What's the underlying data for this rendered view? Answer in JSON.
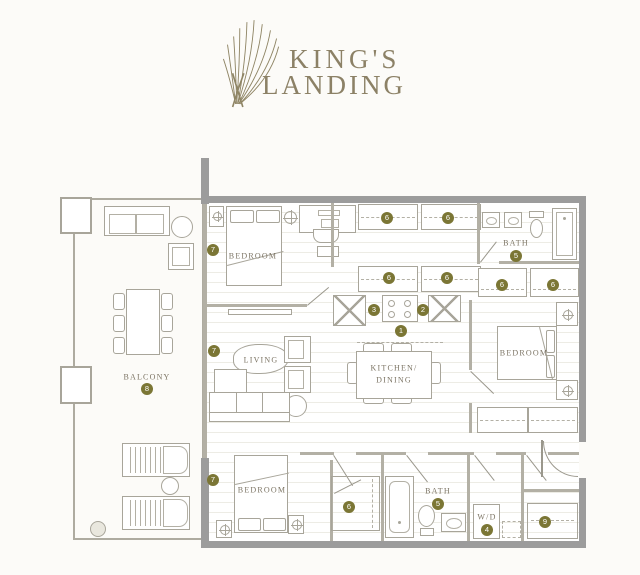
{
  "logo": {
    "line1": "KING'S",
    "line2": "LANDING",
    "icon": "leaf-fan-icon"
  },
  "colors": {
    "brand_gold": "#8c8166",
    "marker_olive": "#7b7635",
    "marker_text": "#ffffff",
    "wall_gray": "#9c9c9c",
    "label_brown": "#7c7464",
    "background": "#fcfbf8"
  },
  "plan": {
    "room_labels": [
      {
        "text": "BEDROOM",
        "x": 253,
        "y": 256
      },
      {
        "text": "BATH",
        "x": 516,
        "y": 243
      },
      {
        "text": "BEDROOM",
        "x": 524,
        "y": 353
      },
      {
        "text": "LIVING",
        "x": 261,
        "y": 360
      },
      {
        "text": "KITCHEN/",
        "x": 394,
        "y": 368
      },
      {
        "text": "DINING",
        "x": 394,
        "y": 380
      },
      {
        "text": "BALCONY",
        "x": 147,
        "y": 377
      },
      {
        "text": "BEDROOM",
        "x": 262,
        "y": 490
      },
      {
        "text": "BATH",
        "x": 438,
        "y": 491
      },
      {
        "text": "W/D",
        "x": 487,
        "y": 517
      }
    ],
    "markers": [
      {
        "n": "1",
        "x": 401,
        "y": 331
      },
      {
        "n": "2",
        "x": 423,
        "y": 310
      },
      {
        "n": "3",
        "x": 374,
        "y": 310
      },
      {
        "n": "4",
        "x": 487,
        "y": 530
      },
      {
        "n": "5",
        "x": 516,
        "y": 256
      },
      {
        "n": "5",
        "x": 438,
        "y": 504
      },
      {
        "n": "6",
        "x": 387,
        "y": 218
      },
      {
        "n": "6",
        "x": 448,
        "y": 218
      },
      {
        "n": "6",
        "x": 389,
        "y": 278
      },
      {
        "n": "6",
        "x": 447,
        "y": 278
      },
      {
        "n": "6",
        "x": 502,
        "y": 285
      },
      {
        "n": "6",
        "x": 553,
        "y": 285
      },
      {
        "n": "6",
        "x": 349,
        "y": 507
      },
      {
        "n": "7",
        "x": 213,
        "y": 250
      },
      {
        "n": "7",
        "x": 214,
        "y": 351
      },
      {
        "n": "7",
        "x": 213,
        "y": 480
      },
      {
        "n": "8",
        "x": 147,
        "y": 389
      },
      {
        "n": "9",
        "x": 545,
        "y": 522
      }
    ]
  }
}
